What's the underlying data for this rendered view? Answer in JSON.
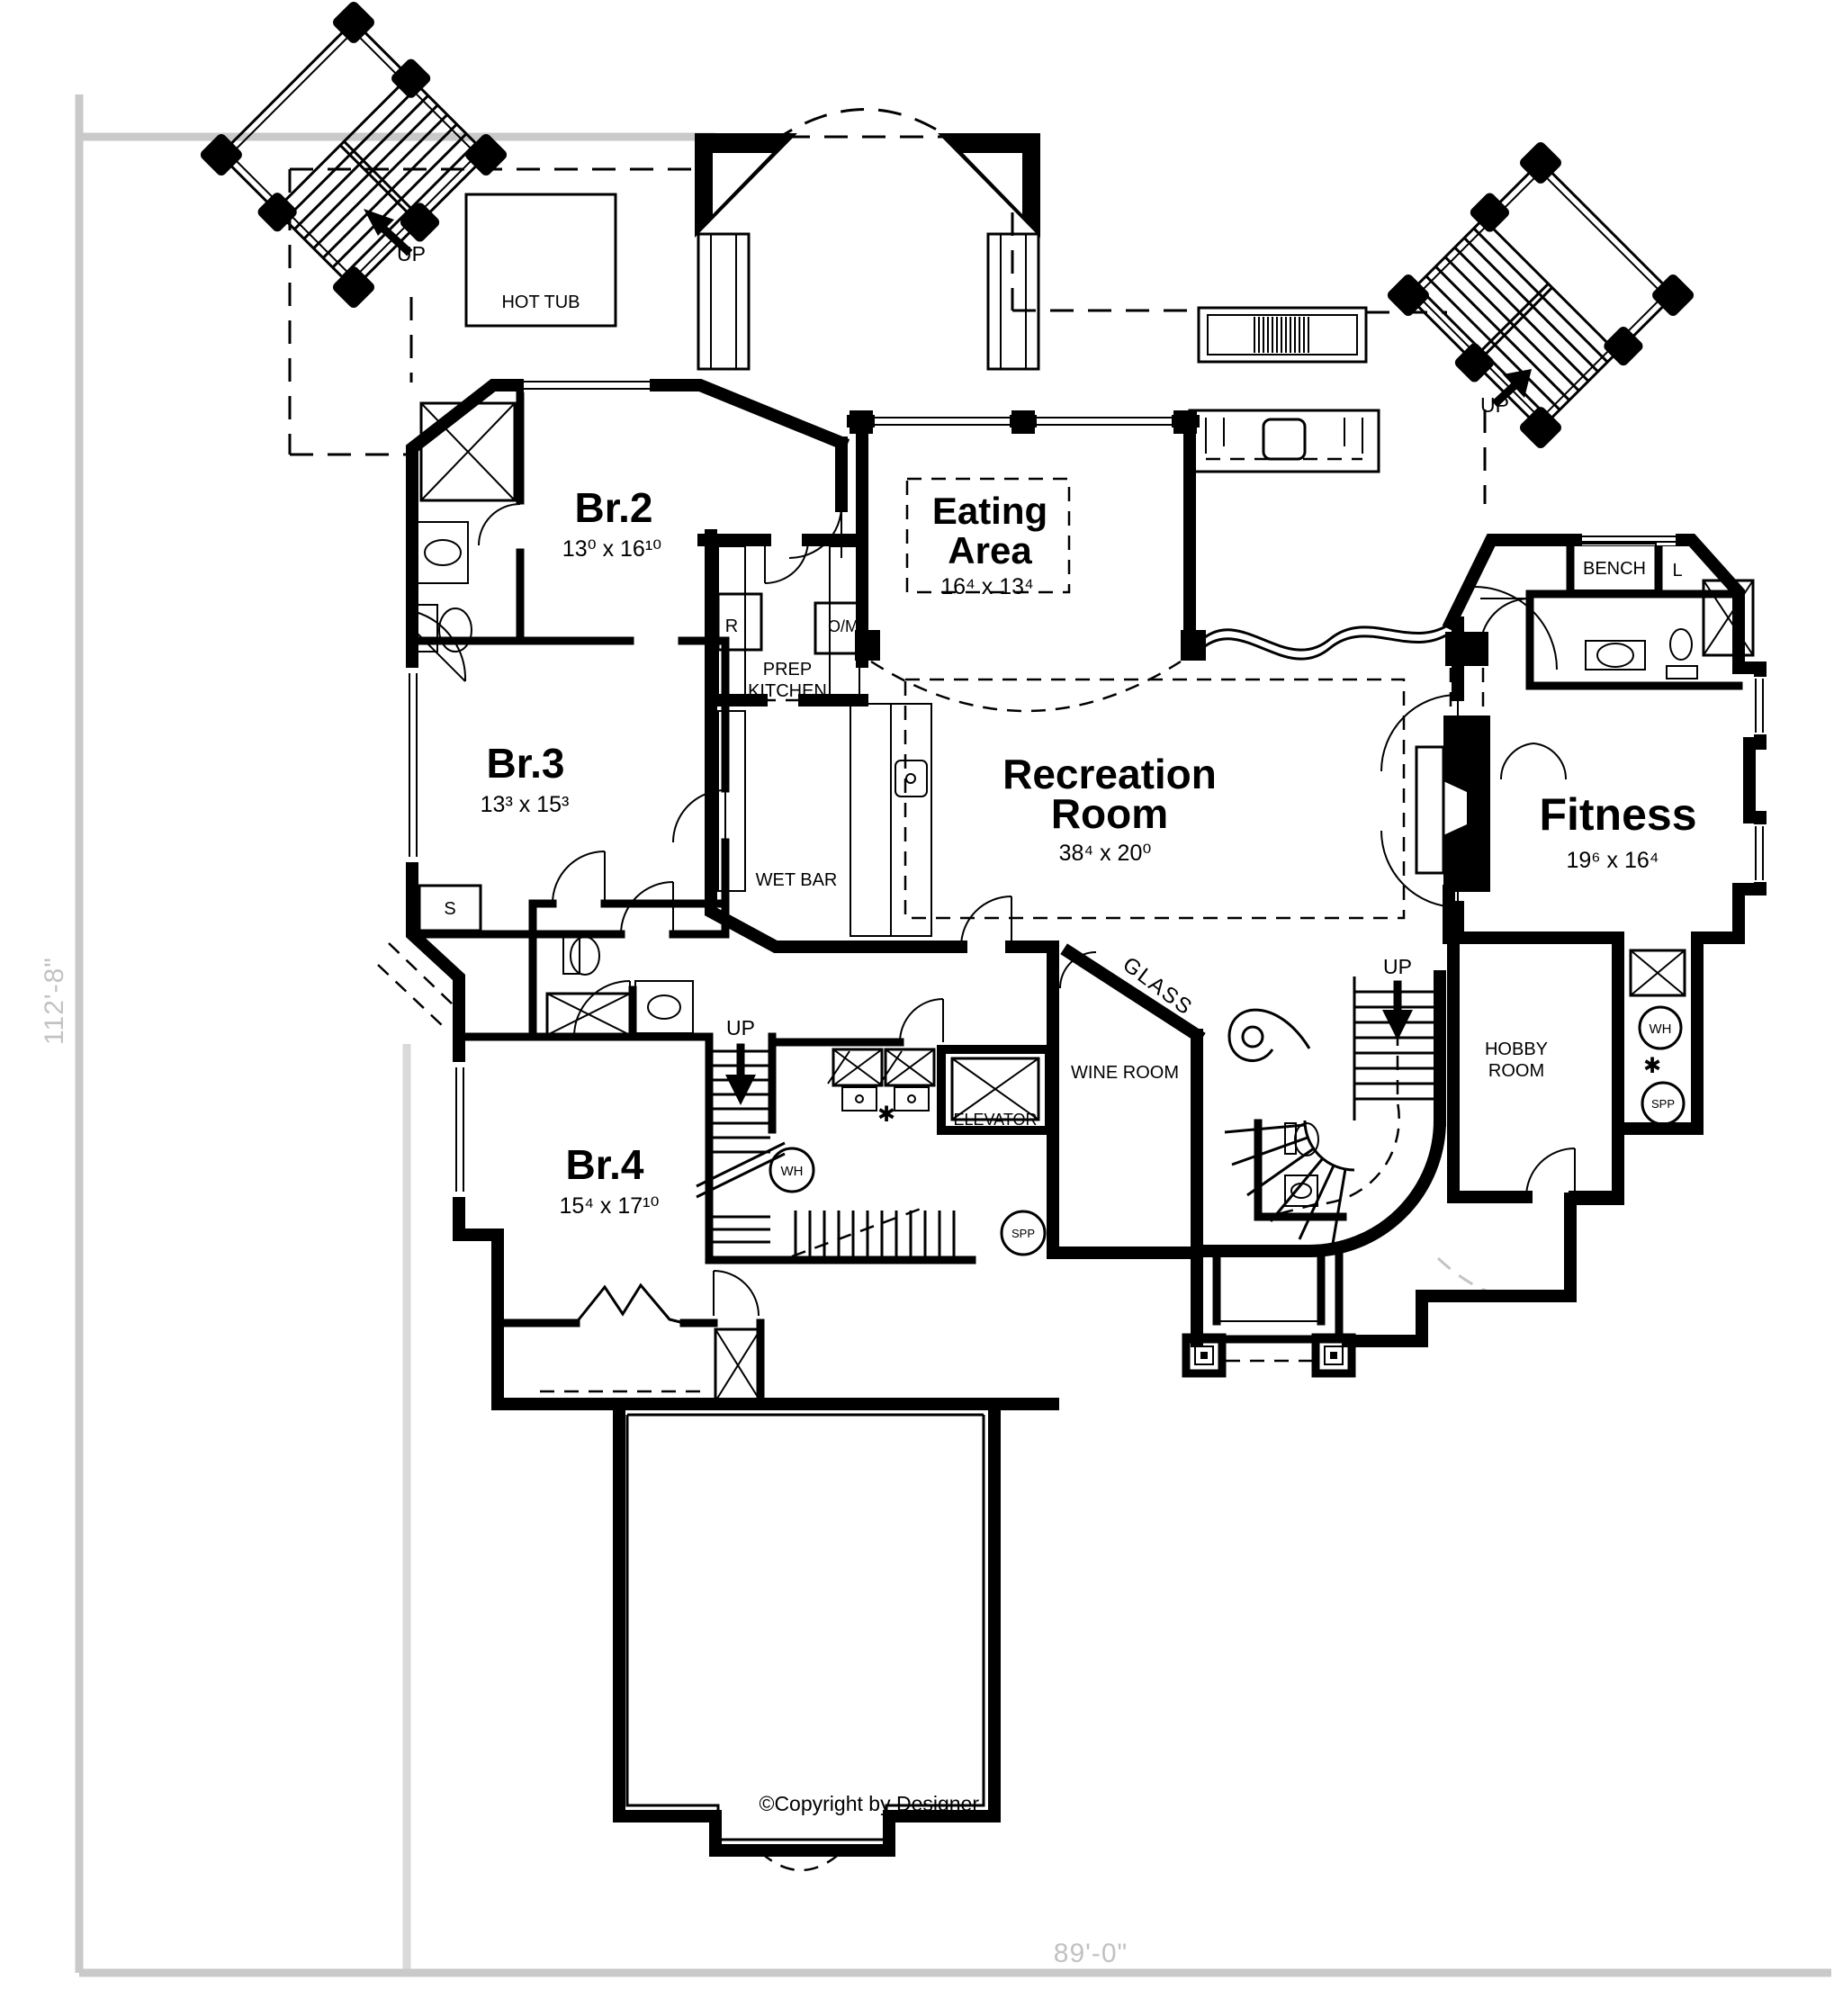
{
  "rooms": {
    "br2": {
      "name": "Br.2",
      "dims": "13⁰ x 16¹⁰"
    },
    "br3": {
      "name": "Br.3",
      "dims": "13³ x 15³"
    },
    "br4": {
      "name": "Br.4",
      "dims": "15⁴ x 17¹⁰"
    },
    "eating": {
      "line1": "Eating",
      "line2": "Area",
      "dims": "16⁴ x 13⁴"
    },
    "recreation": {
      "line1": "Recreation",
      "line2": "Room",
      "dims": "38⁴ x 20⁰"
    },
    "fitness": {
      "name": "Fitness",
      "dims": "19⁶ x 16⁴"
    },
    "wine": {
      "name": "WINE ROOM"
    },
    "hobby": {
      "line1": "HOBBY",
      "line2": "ROOM"
    },
    "prep": {
      "line1": "PREP",
      "line2": "KITCHEN"
    },
    "wet_bar": {
      "name": "WET BAR"
    },
    "hot_tub": {
      "name": "HOT TUB"
    }
  },
  "labels": {
    "up": "UP",
    "elevator": "ELEVATOR",
    "bench": "BENCH",
    "glass": "GLASS",
    "linen": "L",
    "storage": "S",
    "fridge": "R",
    "oven_micro": "O/M",
    "water_heater": "WH",
    "sump_pump": "SPP",
    "star": "✱"
  },
  "dimensions": {
    "left": "112'-8\"",
    "bottom": "89'-0\""
  },
  "copyright": "©Copyright by Designer",
  "colors": {
    "wall": "#000000",
    "dimension_gray": "#c4c4c4",
    "background": "#ffffff"
  }
}
